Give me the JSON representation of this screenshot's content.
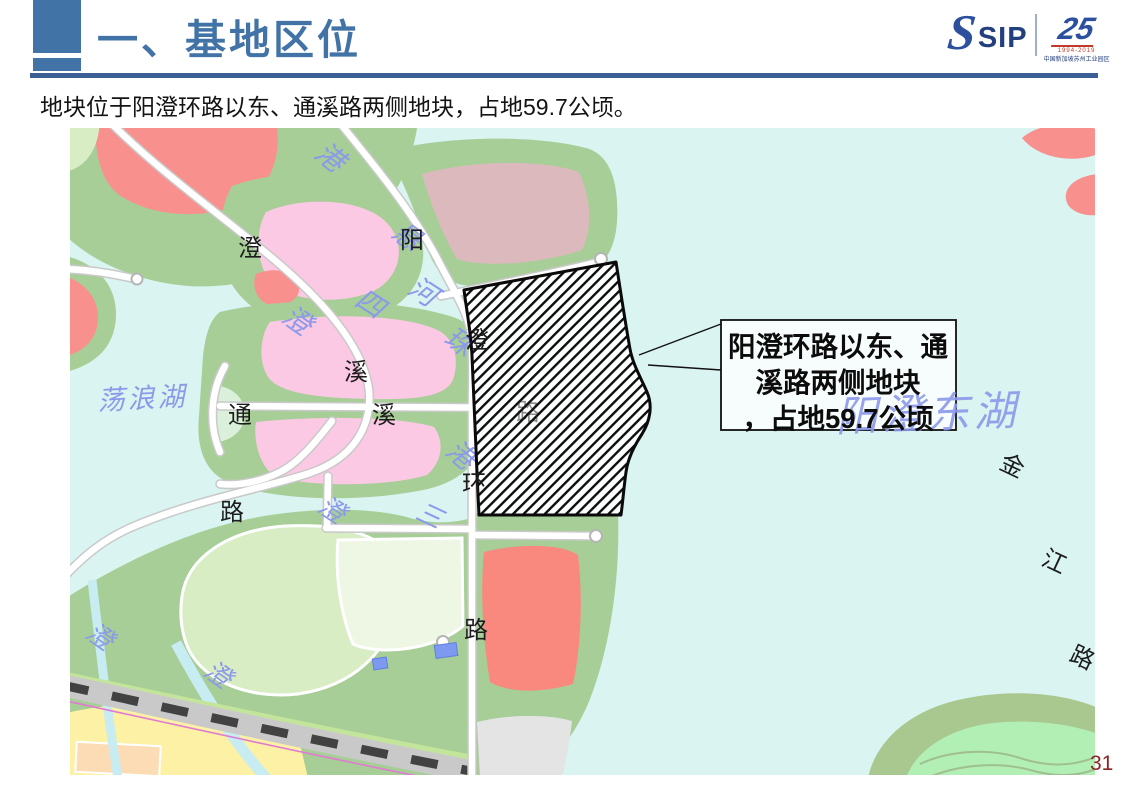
{
  "slide": {
    "page_number": "31"
  },
  "header": {
    "title": "一、基地区位",
    "accent_color": "#4273a7",
    "line_color": "#3b5e95"
  },
  "logo": {
    "s": "S",
    "sip": "SIP",
    "anniversary": "25",
    "years": "1994-2019",
    "org": "中国新加坡苏州工业园区"
  },
  "subtitle": "地块位于阳澄环路以东、通溪路两侧地块，占地59.7公顷。",
  "callout": {
    "line1": "阳澄环路以东、通",
    "line2": "溪路两侧地块",
    "line3": "，占地59.7公顷",
    "border_color": "#111111"
  },
  "map": {
    "colors": {
      "water": "#d9f4f1",
      "land_green": "#a6ce96",
      "parcel_light_green": "#d9edc5",
      "parcel_pale_green": "#eef6e4",
      "parcel_pink": "#fbc9e3",
      "parcel_salmon": "#f8918e",
      "parcel_dusty_rose": "#dcb9bd",
      "parcel_red": "#f9897f",
      "parcel_yellow": "#fcf1a4",
      "parcel_peach": "#fbdcb4",
      "parcel_gray": "#e4e4e4",
      "island_green": "#b2efb5",
      "road": "#ffffff",
      "railway": "#c9c9c9",
      "metro_line": "#e07ad2",
      "stream": "#c7ecf2",
      "building_blue": "#7e99f0",
      "water_label": "#8c99ea",
      "road_label": "#1c1c1c",
      "site_hatch": "#0d0d0d"
    },
    "labels": [
      {
        "t": "港",
        "x": 243,
        "y": 28,
        "r": 38,
        "s": 28,
        "c": "water",
        "layer": "under"
      },
      {
        "t": "悬",
        "x": 320,
        "y": 108,
        "r": 35,
        "s": 28,
        "c": "water",
        "layer": "under"
      },
      {
        "t": "河",
        "x": 336,
        "y": 164,
        "r": 33,
        "s": 28,
        "c": "water",
        "layer": "under"
      },
      {
        "t": "四",
        "x": 283,
        "y": 176,
        "r": 33,
        "s": 28,
        "c": "water",
        "layer": "under"
      },
      {
        "t": "珠",
        "x": 372,
        "y": 214,
        "r": 33,
        "s": 28,
        "c": "water",
        "layer": "under"
      },
      {
        "t": "澄",
        "x": 210,
        "y": 192,
        "r": 35,
        "s": 28,
        "c": "water",
        "layer": "under"
      },
      {
        "t": "荡浪湖",
        "x": 28,
        "y": 282,
        "r": -3,
        "s": 27,
        "c": "water",
        "layer": "under",
        "ls": 3
      },
      {
        "t": "港",
        "x": 374,
        "y": 325,
        "r": 40,
        "s": 28,
        "c": "water",
        "layer": "under"
      },
      {
        "t": "澄",
        "x": 246,
        "y": 382,
        "r": 33,
        "s": 26,
        "c": "water",
        "layer": "under"
      },
      {
        "t": "三",
        "x": 344,
        "y": 390,
        "r": 25,
        "s": 26,
        "c": "water",
        "layer": "under"
      },
      {
        "t": "澄",
        "x": 14,
        "y": 508,
        "r": 35,
        "s": 26,
        "c": "water",
        "layer": "under"
      },
      {
        "t": "澄",
        "x": 132,
        "y": 546,
        "r": 35,
        "s": 26,
        "c": "water",
        "layer": "under"
      },
      {
        "t": "澄",
        "x": 168,
        "y": 128,
        "r": 0,
        "s": 24,
        "c": "road",
        "layer": "under"
      },
      {
        "t": "阳",
        "x": 330,
        "y": 120,
        "r": 0,
        "s": 24,
        "c": "road",
        "layer": "under"
      },
      {
        "t": "溪",
        "x": 274,
        "y": 252,
        "r": 0,
        "s": 24,
        "c": "road",
        "layer": "under"
      },
      {
        "t": "通",
        "x": 158,
        "y": 295,
        "r": 0,
        "s": 24,
        "c": "road",
        "layer": "under"
      },
      {
        "t": "溪",
        "x": 302,
        "y": 295,
        "r": 0,
        "s": 24,
        "c": "road",
        "layer": "under"
      },
      {
        "t": "路",
        "x": 150,
        "y": 392,
        "r": 0,
        "s": 24,
        "c": "road",
        "layer": "under"
      },
      {
        "t": "路",
        "x": 394,
        "y": 510,
        "r": 0,
        "s": 24,
        "c": "road",
        "layer": "under"
      },
      {
        "t": "金",
        "x": 928,
        "y": 340,
        "r": 25,
        "s": 24,
        "c": "road",
        "layer": "under"
      },
      {
        "t": "江",
        "x": 970,
        "y": 436,
        "r": 25,
        "s": 24,
        "c": "road",
        "layer": "under"
      },
      {
        "t": "路",
        "x": 998,
        "y": 532,
        "r": 25,
        "s": 24,
        "c": "road",
        "layer": "under"
      },
      {
        "t": "路",
        "x": 446,
        "y": 292,
        "r": 0,
        "s": 24,
        "c": "road",
        "layer": "over",
        "o": 0.5
      },
      {
        "t": "澄",
        "x": 395,
        "y": 220,
        "r": 0,
        "s": 24,
        "c": "road",
        "layer": "over"
      },
      {
        "t": "环",
        "x": 392,
        "y": 364,
        "r": 0,
        "s": 24,
        "c": "road",
        "layer": "over"
      },
      {
        "t": "阳澄东湖",
        "x": 858,
        "y": 300,
        "r": -2,
        "s": 42,
        "c": "water",
        "layer": "top",
        "anchor": "middle",
        "ls": 4,
        "o": 0.9
      }
    ]
  }
}
